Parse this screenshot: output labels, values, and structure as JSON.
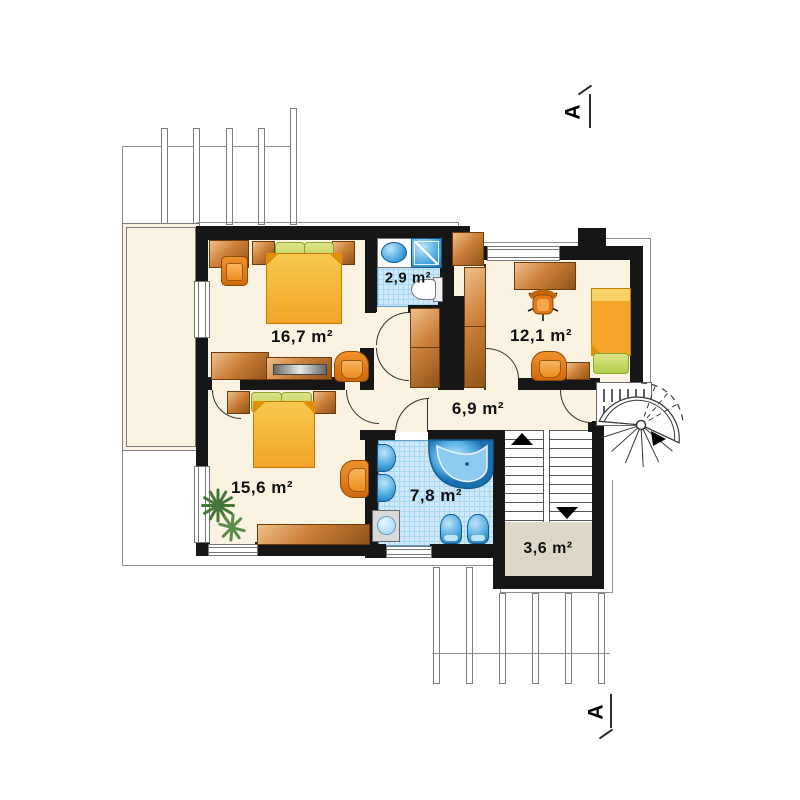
{
  "drawing": {
    "type": "floor-plan",
    "floor": "upper storey"
  },
  "rooms": [
    {
      "id": "bedroom-1",
      "area_label": "16,7 m²"
    },
    {
      "id": "bathroom-small",
      "area_label": "2,9 m²"
    },
    {
      "id": "bedroom-2",
      "area_label": "12,1 m²"
    },
    {
      "id": "hall",
      "area_label": "6,9 m²"
    },
    {
      "id": "bedroom-3",
      "area_label": "15,6 m²"
    },
    {
      "id": "bathroom-large",
      "area_label": "7,8 m²"
    },
    {
      "id": "stair-landing",
      "area_label": "3,6 m²"
    }
  ],
  "section_markers": {
    "top": "A",
    "bottom": "A"
  },
  "colors": {
    "wall": "#161616",
    "floor_cream": "#faf3e2",
    "bathroom_tile": "#cfe9fa",
    "fixture_blue": "#4aa6de",
    "furniture_wood": "#cd803a",
    "bed_orange": "#f2a528",
    "pillow_green": "#b3cc48",
    "landing_floor": "#dcd7c7",
    "outline_gray": "#8f8f8f"
  }
}
